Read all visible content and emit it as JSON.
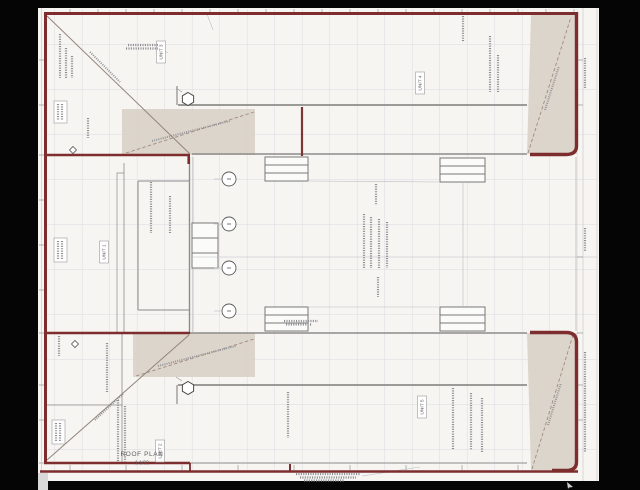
{
  "drawing": {
    "title": "ROOF PLAN",
    "scale": "1 1/32",
    "units": [
      {
        "id": "unit-3",
        "label": "UNIT 3"
      },
      {
        "id": "unit-4",
        "label": "UNIT 4"
      },
      {
        "id": "unit-1",
        "label": "UNIT 1"
      },
      {
        "id": "unit-5",
        "label": "UNIT 5"
      },
      {
        "id": "unit-2",
        "label": "UNIT 2"
      }
    ],
    "colors": {
      "wall_red": "#7d2d2d",
      "roof_shading": "#d9d1c9",
      "sheet": "#f6f5f2",
      "structure_gray": "#8e8c8a",
      "background": "#050505"
    }
  }
}
